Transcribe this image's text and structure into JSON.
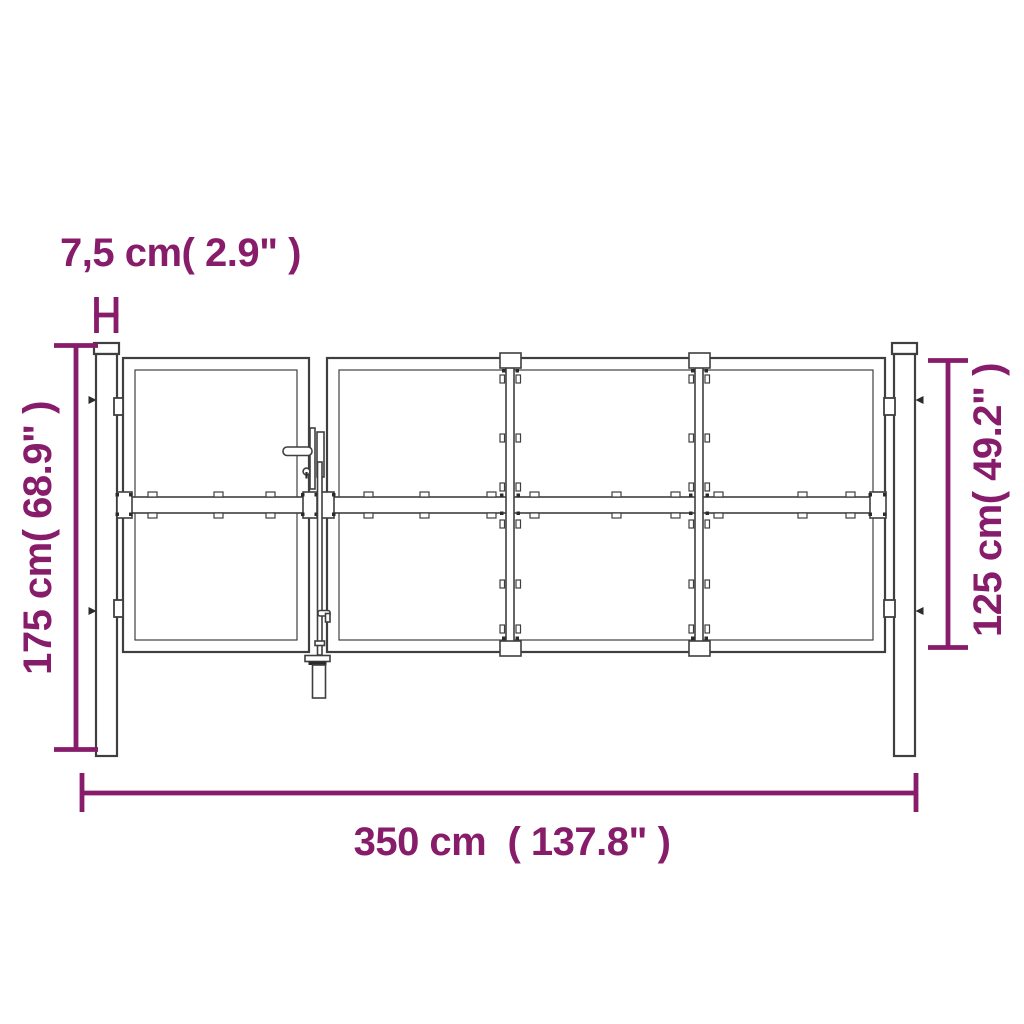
{
  "colors": {
    "accent": "#871c6b",
    "line": "#3f3f3f",
    "background": "#ffffff"
  },
  "labels": {
    "post_width": "7,5 cm( 2.9\" )",
    "post_height": "175 cm( 68.9\" )",
    "gate_height": "125 cm( 49.2\" )",
    "gate_width": "350 cm  ( 137.8\" )"
  }
}
